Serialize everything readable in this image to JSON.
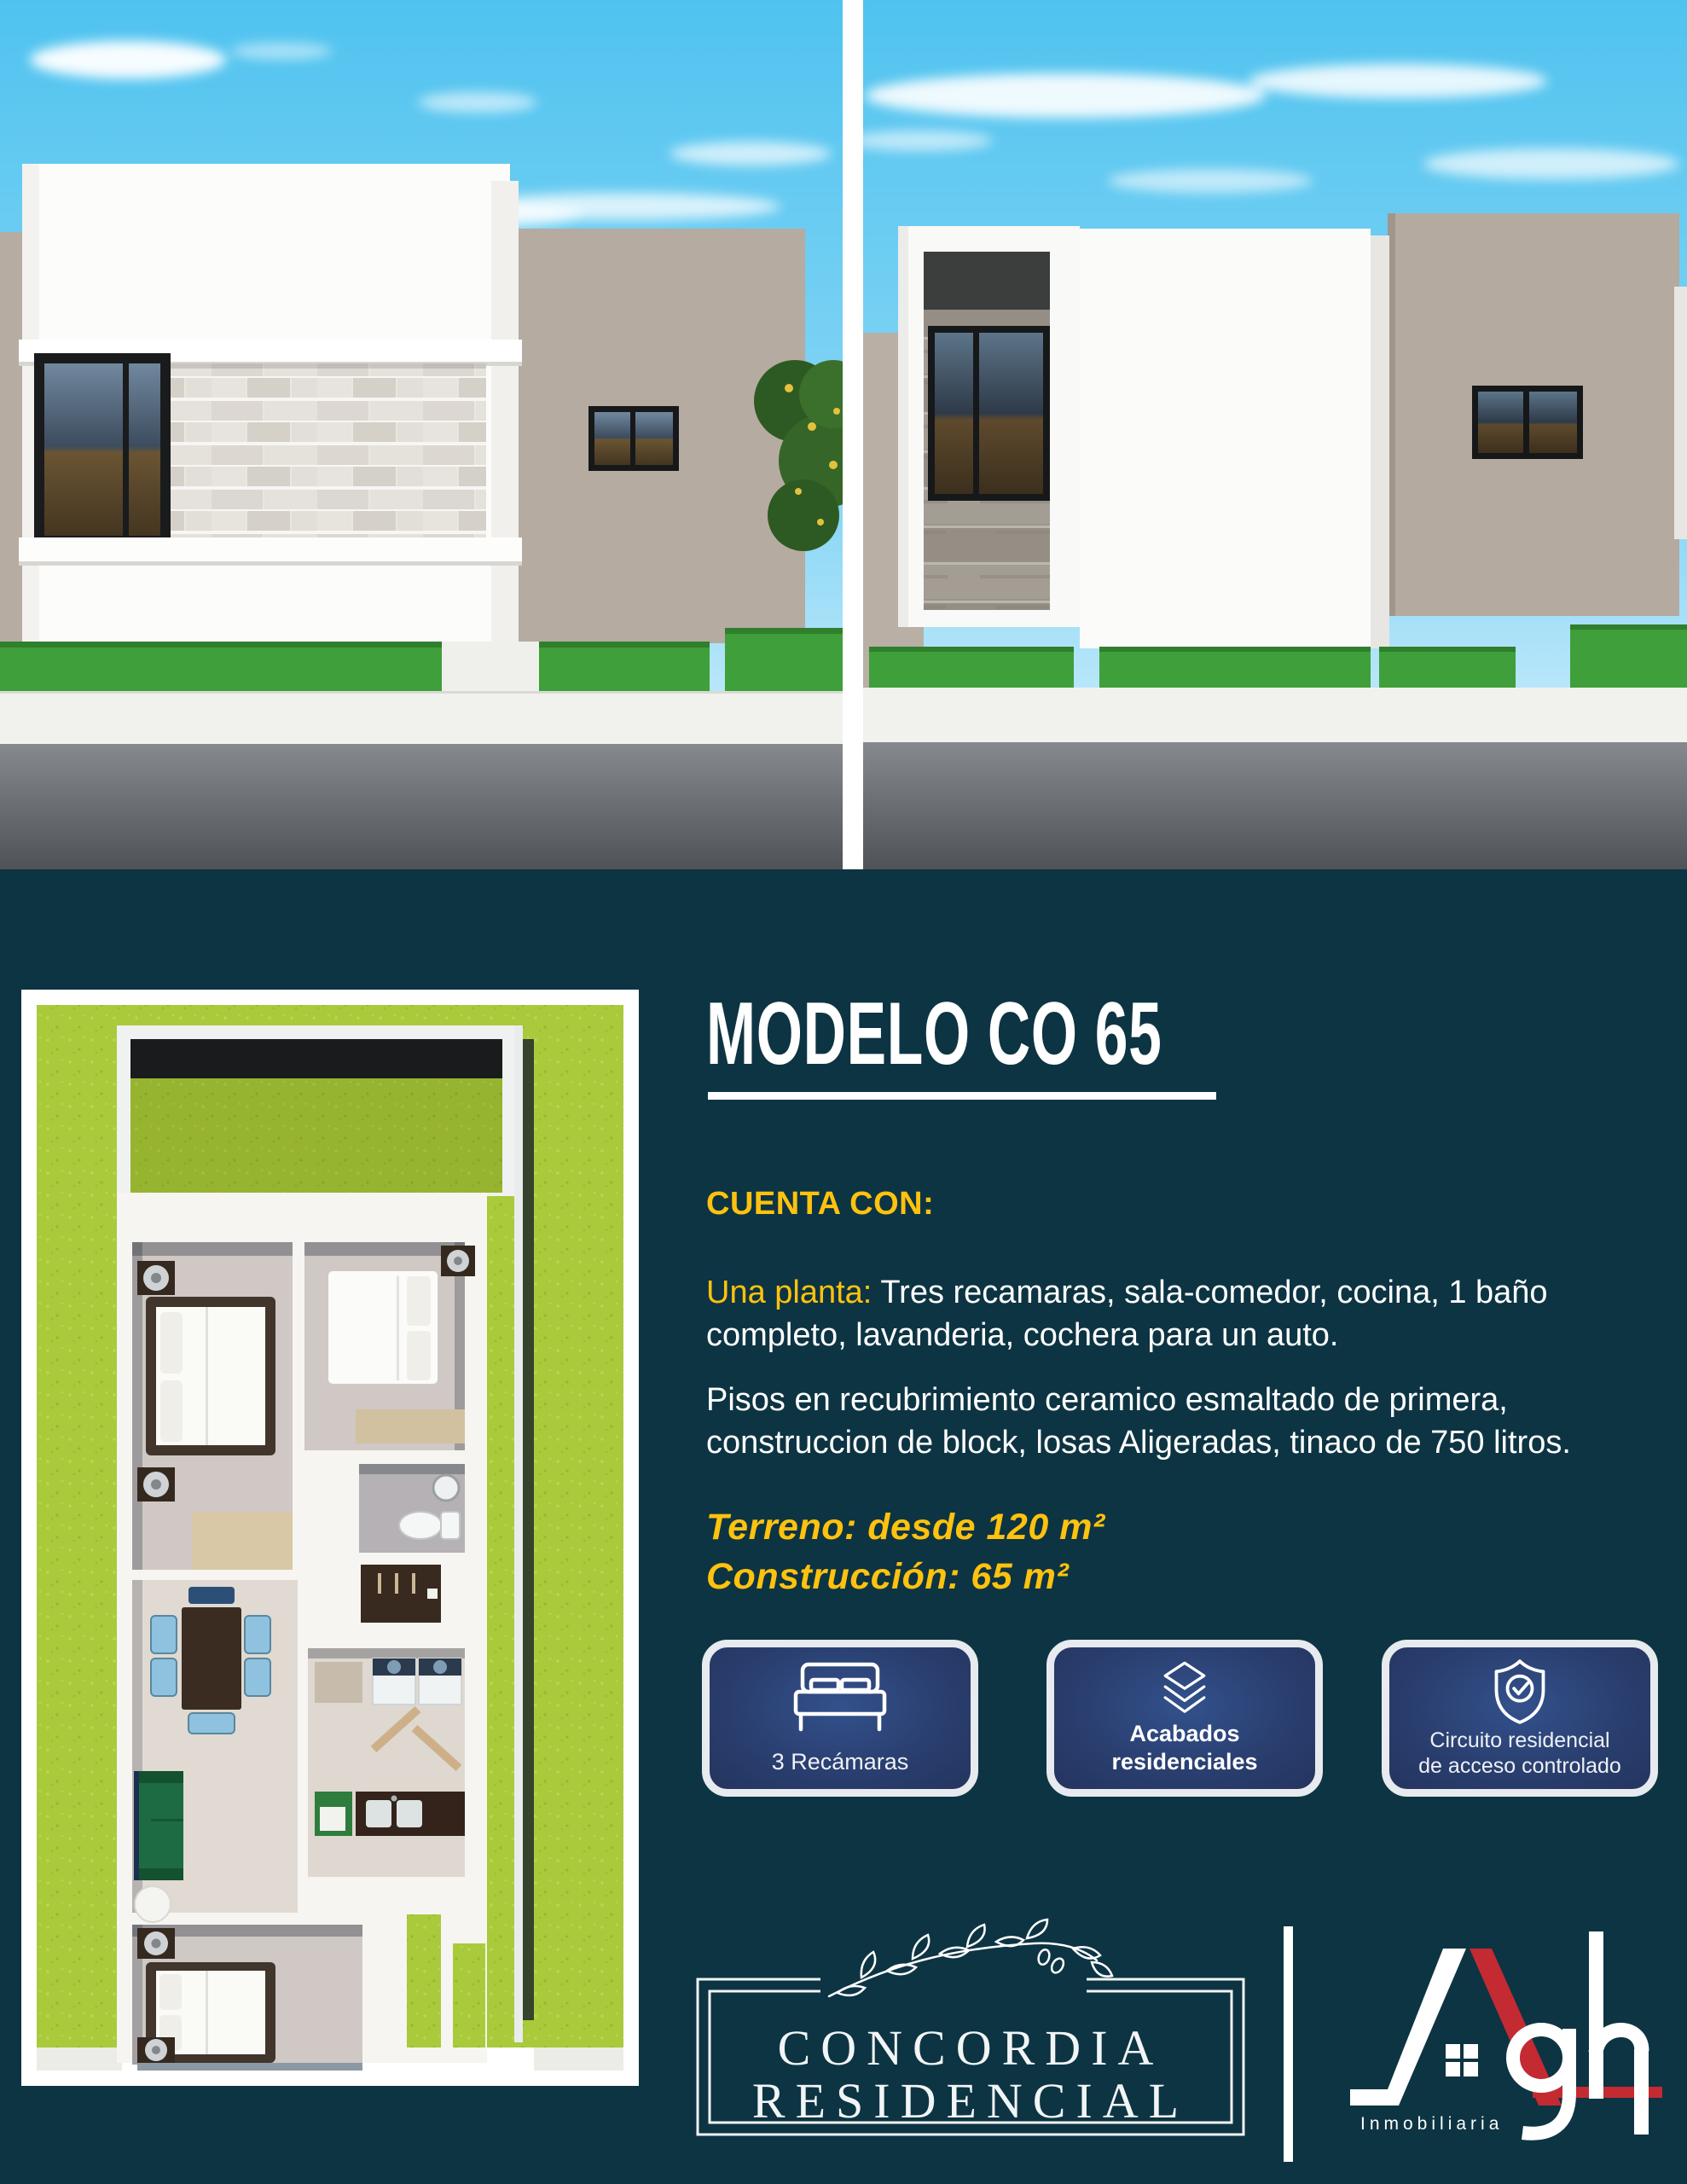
{
  "model": {
    "title": "MODELO CO 65"
  },
  "features": {
    "heading": "CUENTA CON:",
    "plan_label": "Una planta:",
    "plan_text": "Tres recamaras, sala-comedor, cocina, 1 baño completo, lavanderia, cochera para un auto.",
    "finishes_text": "Pisos en recubrimiento ceramico esmaltado de primera, construccion de block, losas Aligeradas, tinaco de 750 litros.",
    "lot": "Terreno: desde 120 m²",
    "construction": "Construcción: 65 m²"
  },
  "badges": [
    {
      "icon": "bed-icon",
      "label": "3 Recámaras"
    },
    {
      "icon": "layers-icon",
      "label": "Acabados residenciales"
    },
    {
      "icon": "shield-check-icon",
      "label_line1": "Circuito residencial",
      "label_line2": "de acceso controlado"
    }
  ],
  "footer": {
    "concordia_line1": "CONCORDIA",
    "concordia_line2": "RESIDENCIAL",
    "agh_suffix": "gh",
    "agh_tagline": "Inmobiliaria"
  },
  "colors": {
    "background_teal": "#0d3443",
    "accent_yellow": "#ffc20e",
    "brand_red": "#c42a32",
    "lawn_green": "#a9ca3b",
    "badge_navy": "#2a3f70",
    "badge_border": "#e7eaee"
  }
}
